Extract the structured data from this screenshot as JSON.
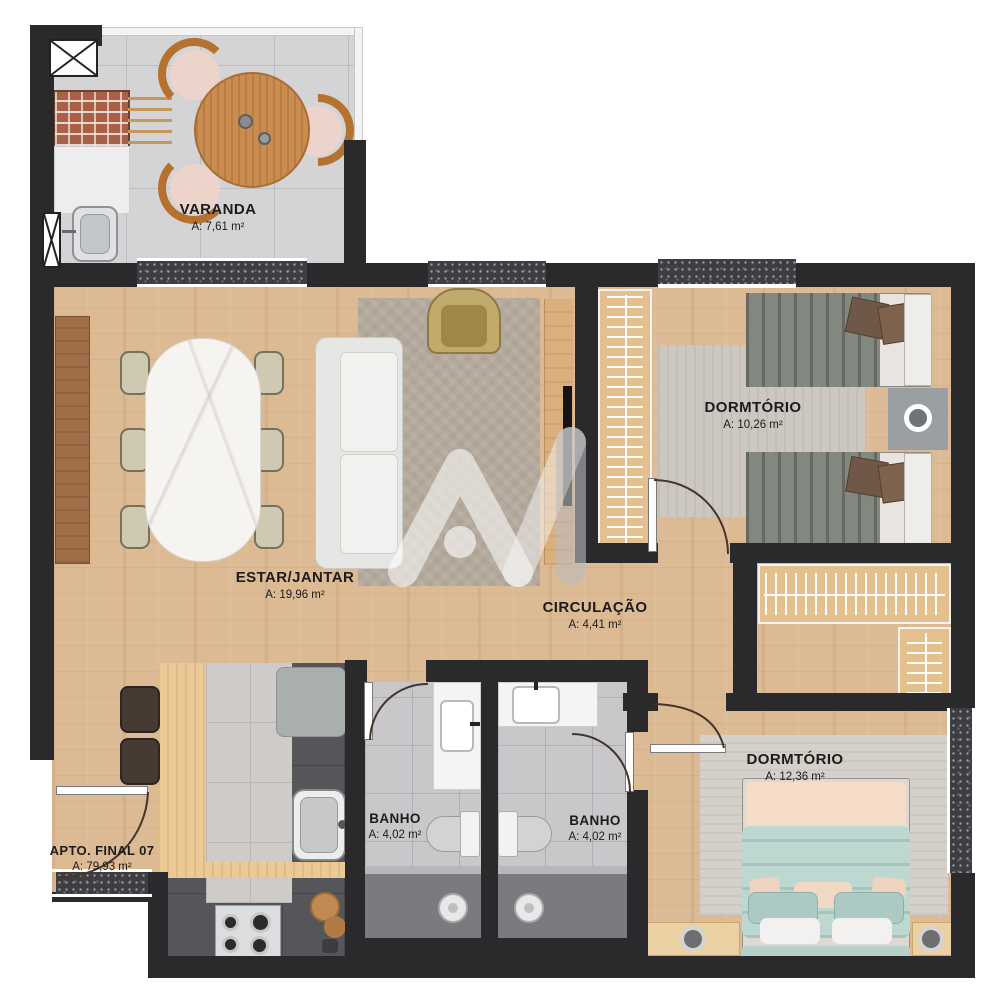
{
  "plan_title": "Apartment floor plan - final 07",
  "rooms": {
    "varanda": {
      "name": "VARANDA",
      "area": "A: 7,61 m²"
    },
    "estar": {
      "name": "ESTAR/JANTAR",
      "area": "A: 19,96 m²"
    },
    "dorm1": {
      "name": "DORMTÓRIO",
      "area": "A: 10,26 m²"
    },
    "circulacao": {
      "name": "CIRCULAÇÃO",
      "area": "A: 4,41 m²"
    },
    "banho1": {
      "name": "BANHO",
      "area": "A: 4,02 m²"
    },
    "banho2": {
      "name": "BANHO",
      "area": "A: 4,02 m²"
    },
    "dorm2": {
      "name": "DORMTÓRIO",
      "area": "A: 12,36 m²"
    },
    "apto": {
      "name": "APTO. FINAL 07",
      "area": "A: 79,93 m²"
    }
  },
  "watermark": {
    "icon": "am-logo-watermark"
  },
  "palette": {
    "wall": "#2a2a2d",
    "wood_floor": "#dcba94",
    "balcony_tile": "#d4d4d6",
    "bath_tile": "#c8c8cb",
    "kitchen_floor": "#55555a",
    "wardrobe_wood": "#e3c08d",
    "bed_teal": "#bdd7d1",
    "bed_peach": "#f4dcc8",
    "bed_gray": "#82877f",
    "pillow_brown": "#6f5847",
    "table_wood": "#ca8c4f",
    "watermark_white": "rgba(255,255,255,0.55)"
  }
}
